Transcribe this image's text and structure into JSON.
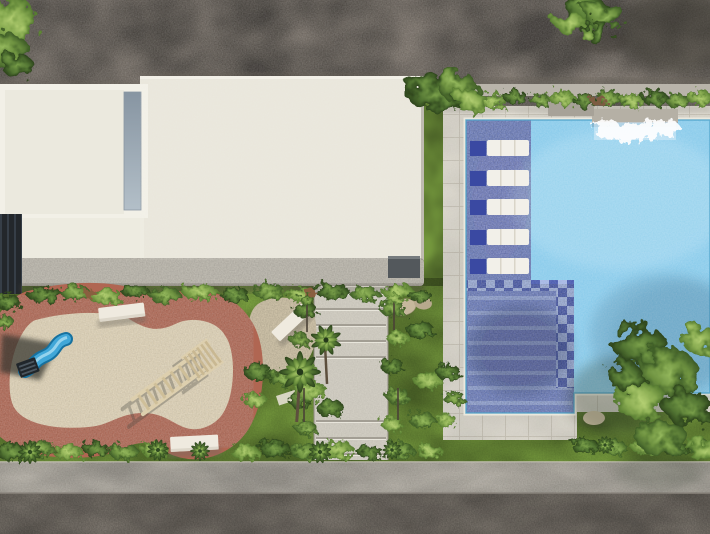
{
  "scene": {
    "type": "aerial-architectural-render",
    "description": "Top-down 3D rendering of a residential amenity area: flat white rooftop at left with skylight slot, swimming pool at right with five in-water loungers on a mosaic tanning shelf, waterfall spout, mosaic entry steps with checker tile border, kidney-shaped sand playground with terracotta border, wave slide, wooden climbing frame, three white benches, central garden stairs, hedges, two large trees, sidewalk and road along the bottom.",
    "building": {
      "label": "rooftop",
      "sections": 2,
      "skylight": true
    },
    "pool": {
      "label": "swimming pool",
      "loungers": 5,
      "features": [
        "waterfall-spout",
        "mosaic-tanning-shelf",
        "mosaic-entry-steps",
        "checker-tile-border",
        "planter-wall"
      ]
    },
    "playground": {
      "label": "playground",
      "surface": "sand with terracotta border",
      "equipment": [
        "wave-slide",
        "climbing-frame",
        "bench",
        "bench",
        "bench"
      ]
    },
    "circulation": {
      "stairs": "central garden steps",
      "sidewalk": true,
      "road": true
    },
    "landscape": {
      "hedges": true,
      "lawn": true,
      "trees": 2,
      "palms": 2,
      "rocks": 3
    }
  },
  "counts": {
    "pool_loungers": 5,
    "benches": 3,
    "stair_flights": 2,
    "mosaic_stripes": 8
  },
  "palette": {
    "dirt": "#8a8177",
    "roof_left": "#ebe9de",
    "roof_right": "#e9e6db",
    "roof_frame": "#f2f0e7",
    "under_white": "#edebe0",
    "skylight_dark": "#8795a2",
    "ledge": "#c7c3b9",
    "dark_facade": "#23272b",
    "dark_box": "#53585c",
    "grass": "#7fa643",
    "wall": "#b9b4aa",
    "deck": "#dbd7cc",
    "water": "#85c9ea",
    "water_line": "#4fa3c9",
    "coping": "#ebe8dd",
    "mosaic": "#6b7ec4",
    "mosaic_light": "#9db0e0",
    "mosaic_dark": "#4153ab",
    "lounger": "#f2f0e9",
    "lounger_shadow": "#3a49a2",
    "foam": "#ffffff",
    "sand": "#e1d4b7",
    "track": "#b06652",
    "gravel_patch": "#d7cbb0",
    "slide_blue": "#41a7d8",
    "slide_dark": "#17719f",
    "wood": "#ddcfae",
    "bench": "#efeadf",
    "stairs": "#d6d2c7",
    "stair_line": "#9b968c",
    "sidewalk": "#b4afa5",
    "road": "#8a837a",
    "rock": "#c6b89c"
  }
}
